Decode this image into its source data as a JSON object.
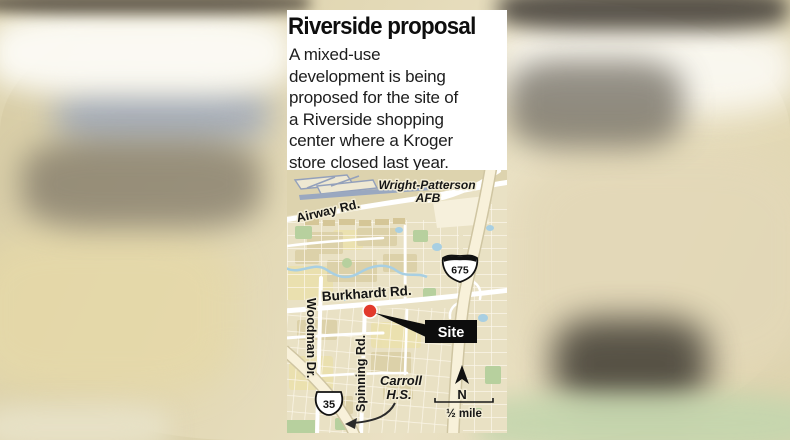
{
  "card": {
    "title": "Riverside proposal",
    "intro_lines": [
      "A mixed-use",
      "development is being",
      "proposed for the site of",
      "a Riverside shopping",
      "center where a Kroger",
      "store closed last year."
    ]
  },
  "map": {
    "labels": {
      "afb_line1": "Wright-Patterson",
      "afb_line2": "AFB",
      "airway": "Airway Rd.",
      "interstate": "675",
      "burkhardt": "Burkhardt Rd.",
      "site": "Site",
      "woodman": "Woodman Dr.",
      "spinning": "Spinning Rd.",
      "us_route": "35",
      "carroll_line1": "Carroll",
      "carroll_line2": "H.S.",
      "compass_north": "N",
      "scale": "½ mile"
    },
    "colors": {
      "land": "#e9e1c4",
      "road": "#ffffff",
      "highway": "#f8f1da",
      "runway": "#9aa8c0",
      "water": "#a8cfe2",
      "park": "#b7d09e",
      "marker": "#e23a2c",
      "callout": "#0d0d0d"
    }
  }
}
